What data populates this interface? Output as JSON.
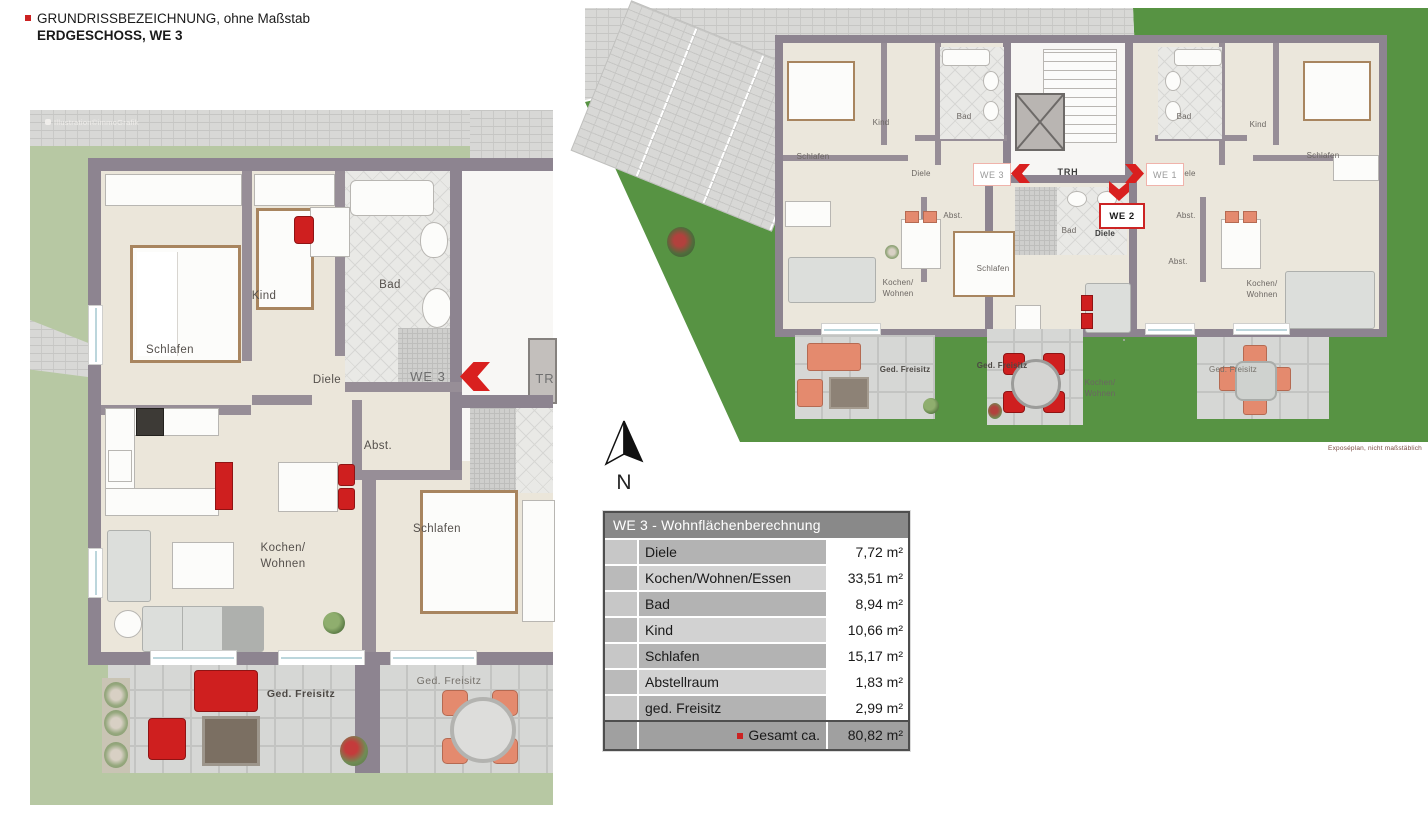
{
  "colors": {
    "accent_red": "#d9201f",
    "wall_gray": "#8d8490",
    "grass_pale": "#b7c8a3",
    "grass_vivid": "#579343"
  },
  "header": {
    "line1": "GRUNDRISSBEZEICHNUNG, ohne Maßstab",
    "line2": "ERDGESCHOSS, WE 3"
  },
  "detail_plan": {
    "watermark": "Illustration©immoGrafik",
    "unit_badge": "WE 3",
    "trh_partial": "TR",
    "labels": {
      "schlafen_main": "Schlafen",
      "kind": "Kind",
      "bad": "Bad",
      "diele": "Diele",
      "abst": "Abst.",
      "kochen_wohnen": "Kochen/\nWohnen",
      "schlafen_neighbor": "Schlafen",
      "freisitz_left": "Ged. Freisitz",
      "freisitz_right": "Ged. Freisitz"
    }
  },
  "overview_plan": {
    "caption": "Exposéplan, nicht maßstäblich",
    "trh": "TRH",
    "badges": {
      "we1": "WE 1",
      "we2": "WE 2",
      "we3": "WE 3"
    },
    "we3": {
      "schlafen": "Schlafen",
      "kind": "Kind",
      "bad": "Bad",
      "diele": "Diele",
      "abst": "Abst.",
      "kochen": "Kochen/\nWohnen",
      "freisitz": "Ged. Freisitz"
    },
    "we2": {
      "bad": "Bad",
      "diele": "Diele",
      "schlafen": "Schlafen",
      "kochen": "Kochen/\nWohnen",
      "freisitz": "Ged. Freisitz"
    },
    "we1": {
      "diele": "Diele",
      "bad": "Bad",
      "abst_upper": "Abst.",
      "abst_lower": "Abst.",
      "kind": "Kind",
      "schlafen": "Schlafen",
      "kochen": "Kochen/\nWohnen",
      "freisitz": "Ged. Freisitz"
    }
  },
  "compass": {
    "label": "N"
  },
  "table": {
    "title": "WE 3 - Wohnflächenberechnung",
    "rows": [
      {
        "label": "Diele",
        "value": "7,72 m²"
      },
      {
        "label": "Kochen/Wohnen/Essen",
        "value": "33,51 m²"
      },
      {
        "label": "Bad",
        "value": "8,94 m²"
      },
      {
        "label": "Kind",
        "value": "10,66 m²"
      },
      {
        "label": "Schlafen",
        "value": "15,17 m²"
      },
      {
        "label": "Abstellraum",
        "value": "1,83 m²"
      },
      {
        "label": "ged. Freisitz",
        "value": "2,99 m²"
      }
    ],
    "total": {
      "label": "Gesamt ca.",
      "value": "80,82 m²"
    }
  }
}
